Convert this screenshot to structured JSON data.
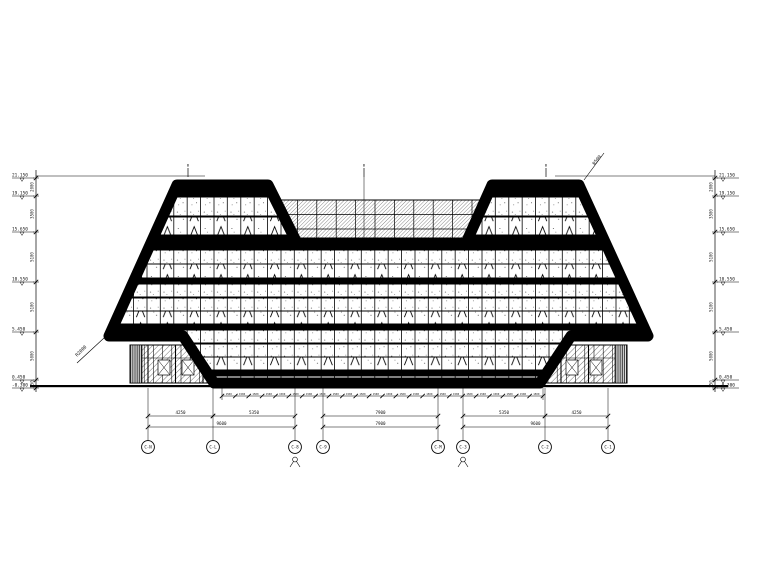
{
  "drawing": {
    "kind": "building-elevation",
    "line_color": "#000000",
    "paper_color": "#ffffff"
  },
  "annotations": {
    "radius_corner_left": "R2000",
    "radius_corner_right": "R500",
    "apex_marks": [
      {
        "label": "B",
        "x": 188
      },
      {
        "label": "B",
        "x": 364
      },
      {
        "label": "B",
        "x": 546
      }
    ]
  },
  "levels": {
    "items": [
      {
        "value": "21.150",
        "y": 178
      },
      {
        "value": "19.150",
        "y": 196
      },
      {
        "value": "15.650",
        "y": 232
      },
      {
        "value": "10.550",
        "y": 282
      },
      {
        "value": "5.450",
        "y": 332
      },
      {
        "value": "0.450",
        "y": 380
      },
      {
        "value": "-0.300",
        "y": 388
      }
    ],
    "segments": [
      {
        "value": "2000"
      },
      {
        "value": "3500"
      },
      {
        "value": "5100"
      },
      {
        "value": "5100"
      },
      {
        "value": "5000"
      },
      {
        "value": "750"
      }
    ]
  },
  "axes": {
    "bubbles": [
      {
        "label": "C-N",
        "x": 148
      },
      {
        "label": "C-L",
        "x": 213
      },
      {
        "label": "C-8",
        "x": 295
      },
      {
        "label": "C-9",
        "x": 323
      },
      {
        "label": "C-M",
        "x": 438
      },
      {
        "label": "C-3",
        "x": 463
      },
      {
        "label": "C-2",
        "x": 545
      },
      {
        "label": "C-1",
        "x": 608
      }
    ]
  },
  "dims": {
    "row1": [
      {
        "value": "4250",
        "x1": 148,
        "x2": 213
      },
      {
        "value": "5350",
        "x1": 213,
        "x2": 295
      },
      {
        "value": "7900",
        "x1": 323,
        "x2": 438
      },
      {
        "value": "5350",
        "x1": 463,
        "x2": 545
      },
      {
        "value": "4250",
        "x1": 545,
        "x2": 608
      }
    ],
    "row2": [
      {
        "value": "9600",
        "x1": 148,
        "x2": 295
      },
      {
        "value": "7900",
        "x1": 323,
        "x2": 438
      },
      {
        "value": "9600",
        "x1": 463,
        "x2": 608
      }
    ],
    "chain": {
      "value": "1500",
      "count": 24,
      "x1": 222,
      "x2": 543
    }
  }
}
